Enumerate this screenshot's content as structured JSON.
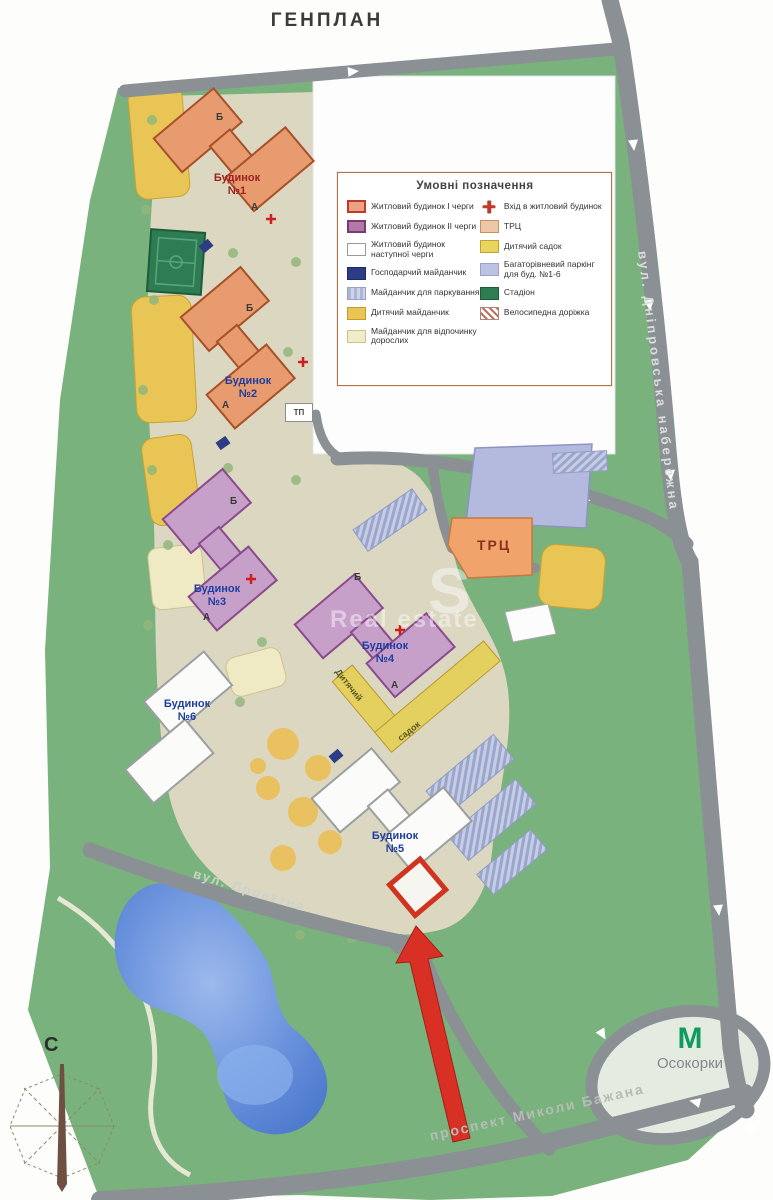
{
  "page": {
    "title": "ГЕНПЛАН"
  },
  "legend": {
    "title": "Умовні позначення",
    "left_items": [
      {
        "type": "phase1",
        "label": "Житловий будинок I черги"
      },
      {
        "type": "phase2",
        "label": "Житловий будинок II черги"
      },
      {
        "type": "future",
        "label": "Житловий будинок наступної черги"
      },
      {
        "type": "utility",
        "label": "Господарчий майданчик"
      },
      {
        "type": "parking",
        "label": "Майданчик для паркування"
      },
      {
        "type": "playground",
        "label": "Дитячий майданчик"
      },
      {
        "type": "rest",
        "label": "Майданчик для відпочинку дорослих"
      }
    ],
    "right_items": [
      {
        "type": "entrance",
        "label": "Вхід в житловий будинок"
      },
      {
        "type": "mall",
        "label": "ТРЦ"
      },
      {
        "type": "kindergarten",
        "label": "Дитячий садок"
      },
      {
        "type": "garage",
        "label": "Багаторівневий паркінг для буд. №1-6"
      },
      {
        "type": "stadium",
        "label": "Стадіон"
      },
      {
        "type": "bike",
        "label": "Велосипедна доріжка"
      }
    ]
  },
  "buildings": [
    {
      "name": "Будинок",
      "number": "№1",
      "sections": [
        "Б",
        "А"
      ]
    },
    {
      "name": "Будинок",
      "number": "№2",
      "sections": [
        "Б",
        "А"
      ]
    },
    {
      "name": "Будинок",
      "number": "№3",
      "sections": [
        "Б",
        "А"
      ]
    },
    {
      "name": "Будинок",
      "number": "№4",
      "sections": [
        "Б",
        "А"
      ]
    },
    {
      "name": "Будинок",
      "number": "№5",
      "sections": []
    },
    {
      "name": "Будинок",
      "number": "№6",
      "sections": []
    }
  ],
  "map_labels": {
    "mall": "ТРЦ",
    "substation": "ТП",
    "kindergarten_part1": "Дитячий",
    "kindergarten_part2": "садок"
  },
  "streets": {
    "right": "вул. Дніпровська набережна",
    "middle": "вул. Проектна",
    "bottom": "проспект Миколи Бажана"
  },
  "metro": {
    "symbol": "М",
    "name": "Осокорки"
  },
  "compass": {
    "north": "С"
  },
  "watermark": {
    "letter": "S",
    "text": "Real estate"
  },
  "colors": {
    "highlight_red": "#d93025",
    "phase1_building": "#e89b6e",
    "phase2_building": "#c7a0ca",
    "future_building": "#fbfbf9",
    "road_gray": "#8b9095",
    "site_green": "#79b27c",
    "inner_beige": "#dcd7c1",
    "pond_blue": "#5b86d8",
    "metro_green": "#0f9b5f",
    "kindergarten_yellow": "#e4d05e",
    "garage_lavender": "#b4badd",
    "mall_orange": "#f0a36a",
    "stadium_green": "#2e7d52"
  }
}
